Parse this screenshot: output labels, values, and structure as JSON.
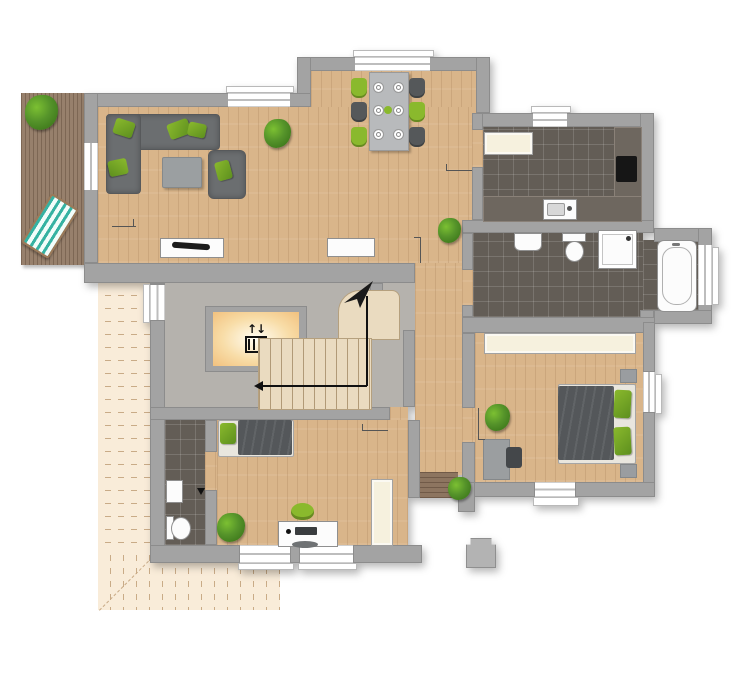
{
  "meta": {
    "title": "apartment-floor-plan",
    "type": "architectural-floor-plan",
    "visible_text": "none"
  },
  "palette": {
    "bg": "#ffffff",
    "wall": "#a3a3a3",
    "wood": "#d9b58a",
    "deck": "#97806c",
    "tile": "#635d56",
    "stair_floor": "#b5b2ad",
    "stair_tread": "#eadbc0",
    "stair_line": "#b19a77",
    "patio": "#f9ecd9",
    "patio_line": "#c9ab87",
    "cream": "#f6f1de",
    "white_fixture": "#fcfcfc",
    "fixture_edge": "#8f8f8f",
    "sofa": "#6b6e70",
    "sofa_edge": "#57595b",
    "blanket": "#54575a",
    "green": "#8ab92d",
    "green_dark": "#5d8f1e",
    "plant": "#3f7a1c",
    "plant_light": "#7cc032",
    "table_gray": "#b8babc",
    "counter": "#6e675f",
    "cooktop": "#161616",
    "glow_center": "#fffdf4",
    "glow_edge": "#f2c17e",
    "arrow": "#111111"
  },
  "elevator": {
    "icon_glyph": "↑↓",
    "icon_name": "elevator-icon"
  },
  "rooms": [
    {
      "name": "terrace-deck",
      "floor": "wood-deck"
    },
    {
      "name": "living-dining-room",
      "floor": "wood"
    },
    {
      "name": "kitchen",
      "floor": "dark-tile"
    },
    {
      "name": "bathroom",
      "floor": "dark-tile"
    },
    {
      "name": "bedroom-right",
      "floor": "wood"
    },
    {
      "name": "bedroom-bottom",
      "floor": "wood"
    },
    {
      "name": "wc",
      "floor": "dark-tile"
    },
    {
      "name": "hallway",
      "floor": "wood"
    },
    {
      "name": "stairwell",
      "floor": "gray-stone"
    },
    {
      "name": "patio-outline",
      "floor": "dashed-beige"
    }
  ],
  "furniture": {
    "living_room": [
      "corner-sofa",
      "armchair",
      "coffee-table",
      "tv-sideboard",
      "sideboard",
      "potted-plant"
    ],
    "dining": [
      "dining-table",
      "chairs-green-and-gray",
      "plates",
      "centerpiece"
    ],
    "kitchen": [
      "tall-cabinet",
      "l-shaped-counter",
      "cooktop",
      "sink"
    ],
    "bathroom": [
      "washbasin",
      "toilet",
      "shower",
      "bathtub"
    ],
    "bedroom_right": [
      "double-bed",
      "green-pillows",
      "nightstands",
      "wardrobe",
      "desk",
      "chair",
      "potted-plant"
    ],
    "bedroom_bottom": [
      "single-bed",
      "desk",
      "office-chair",
      "wardrobe",
      "potted-plant"
    ],
    "wc": [
      "toilet",
      "wall-cabinet"
    ],
    "stairwell": [
      "elevator",
      "staircase",
      "direction-arrow",
      "north-arrow"
    ],
    "terrace": [
      "sun-lounger",
      "potted-plant"
    ],
    "hallway": [
      "potted-plant"
    ],
    "exterior": [
      "chimney",
      "entrance-steps",
      "porch-plant"
    ]
  }
}
